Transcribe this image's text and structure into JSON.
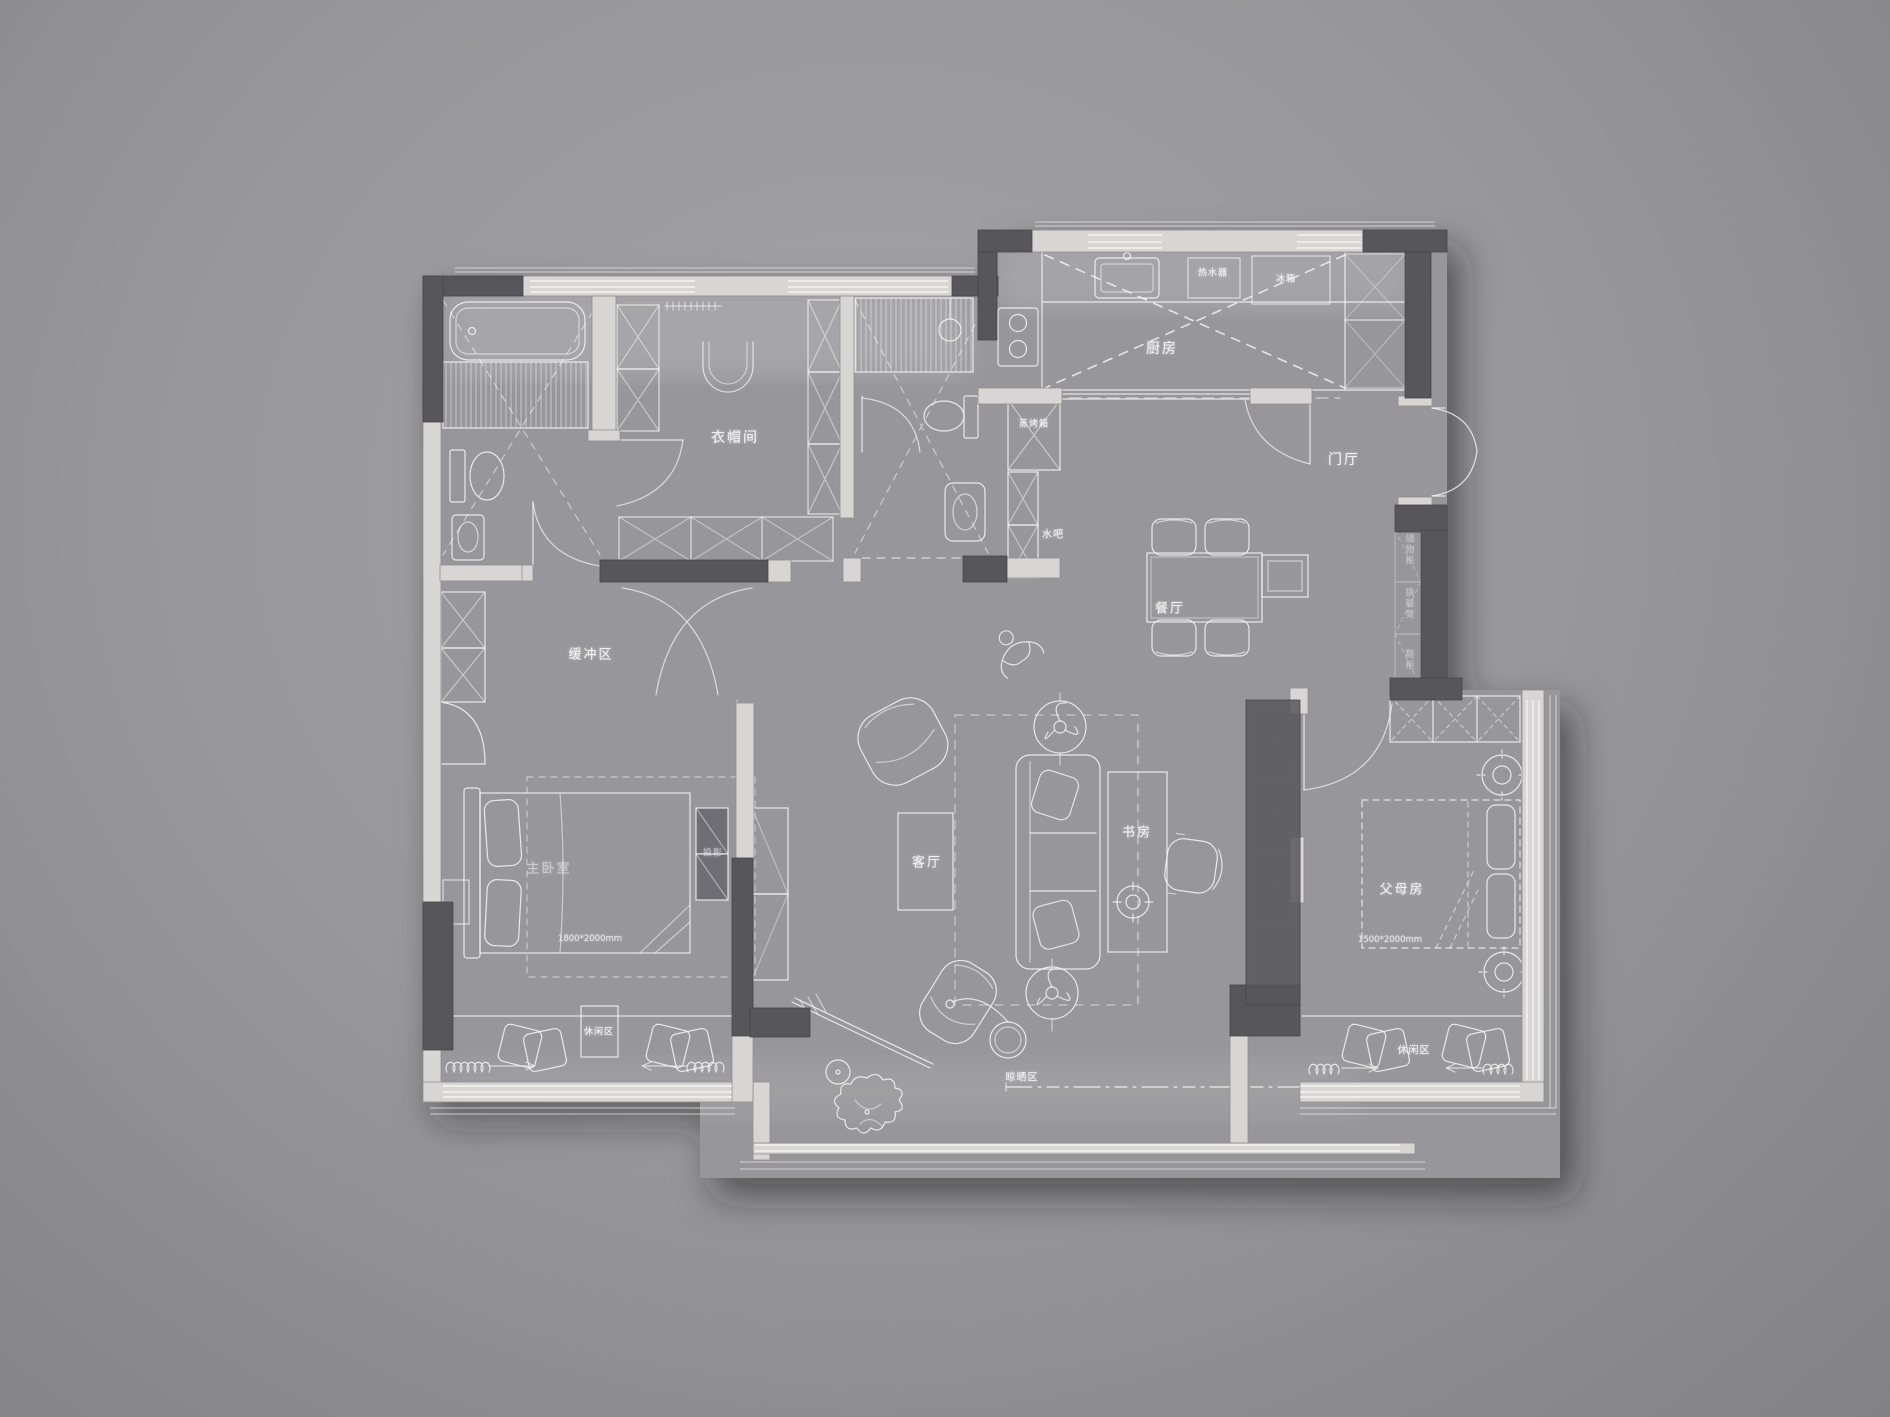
{
  "meta": {
    "type": "residential floor plan",
    "style": "grayscale CAD interior layout, white linework on gray, dark structural walls",
    "language": "zh-CN"
  },
  "colors": {
    "background": "#98989b",
    "floor": "#97979b",
    "wall_dark": "#57575b",
    "wall_light": "#d8d6d5",
    "line": "#f5f5f5"
  },
  "rooms": {
    "cloakroom": "衣帽间",
    "kitchen": "厨房",
    "foyer": "门厅",
    "dining": "餐厅",
    "water_bar": "水吧",
    "buffer_zone": "缓冲区",
    "master_bedroom": "主卧室",
    "living_room": "客厅",
    "study": "书房",
    "parents_room": "父母房",
    "leisure_master": "休闲区",
    "leisure_parents": "休闲区",
    "drying_area": "晾晒区"
  },
  "fixtures": {
    "steam_oven": "蒸烤箱",
    "water_heater": "热水器",
    "fridge": "冰箱",
    "projector": "投影",
    "entry_storage": "储物柜",
    "shoe_bench": "换鞋凳",
    "shoe_cabinet": "鞋柜"
  },
  "dimensions": {
    "master_bed": "1800*2000mm",
    "parents_bed": "1500*2000mm"
  }
}
